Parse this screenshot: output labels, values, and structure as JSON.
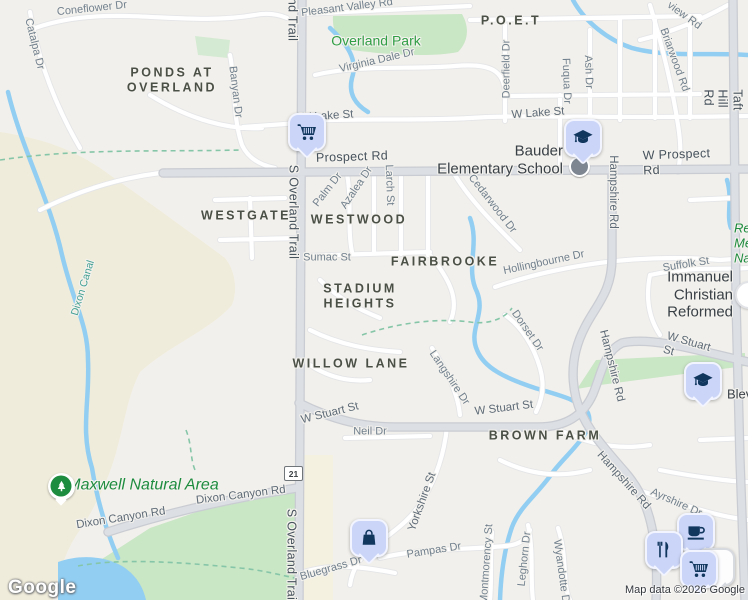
{
  "map": {
    "watermark": "Google",
    "attribution": "Map data ©2026 Google",
    "route_shield": "21",
    "colors": {
      "land": "#f2f0ec",
      "terrain": "#f0ecdb",
      "park": "#c9e6c5",
      "water": "#92cef2",
      "road_major": "#dcdfe4",
      "road_minor": "#ffffff",
      "marker_fill": "#cbd5f8",
      "marker_glyph": "#11375e",
      "poi_green": "#2f9e44",
      "nature_pin_green": "#1e8c3f"
    },
    "neighborhoods": [
      {
        "t": "PONDS AT\nOVERLAND",
        "x": 172,
        "y": 80
      },
      {
        "t": "WESTGATE",
        "x": 246,
        "y": 216
      },
      {
        "t": "WESTWOOD",
        "x": 359,
        "y": 220
      },
      {
        "t": "P.O.E.T",
        "x": 511,
        "y": 21
      },
      {
        "t": "FAIRBROOKE",
        "x": 445,
        "y": 262
      },
      {
        "t": "STADIUM\nHEIGHTS",
        "x": 360,
        "y": 296
      },
      {
        "t": "WILLOW LANE",
        "x": 351,
        "y": 364
      },
      {
        "t": "BROWN FARM",
        "x": 545,
        "y": 436
      }
    ],
    "streets": [
      {
        "t": "Coneflower Dr",
        "x": 92,
        "y": 9,
        "r": -6,
        "c": "s1"
      },
      {
        "t": "Catalpa Dr",
        "x": 34,
        "y": 44,
        "r": 76,
        "c": "s1"
      },
      {
        "t": "Pleasant Valley Rd",
        "x": 347,
        "y": 8,
        "r": -7,
        "c": "s1"
      },
      {
        "t": "S Overland Trail",
        "x": 292,
        "y": -6,
        "r": 90,
        "c": "s3"
      },
      {
        "t": "S Overland Trail",
        "x": 293,
        "y": 212,
        "r": 90,
        "c": "s3"
      },
      {
        "t": "S Overland Trail",
        "x": 291,
        "y": 556,
        "r": 90,
        "c": "s3"
      },
      {
        "t": "S Taft Hill Rd",
        "x": 730,
        "y": 100,
        "r": 90,
        "c": "s3"
      },
      {
        "t": "W Lake St",
        "x": 327,
        "y": 117,
        "r": -4,
        "c": "s2"
      },
      {
        "t": "W Lake St",
        "x": 538,
        "y": 114,
        "r": -4,
        "c": "s2"
      },
      {
        "t": "Virginia Dale Dr",
        "x": 377,
        "y": 61,
        "r": -13,
        "c": "s1"
      },
      {
        "t": "Banyan Dr",
        "x": 235,
        "y": 92,
        "r": 83,
        "c": "s1"
      },
      {
        "t": "Deerfield Dr",
        "x": 507,
        "y": 69,
        "r": -90,
        "c": "s1"
      },
      {
        "t": "Fuqua Dr",
        "x": 566,
        "y": 81,
        "r": 88,
        "c": "s1"
      },
      {
        "t": "Ash Dr",
        "x": 588,
        "y": 72,
        "r": 88,
        "c": "s1"
      },
      {
        "t": "Briarwood Rd",
        "x": 674,
        "y": 60,
        "r": 70,
        "c": "s1"
      },
      {
        "t": "view Rd",
        "x": 684,
        "y": 16,
        "r": 36,
        "c": "s1"
      },
      {
        "t": "Prospect Rd",
        "x": 352,
        "y": 157,
        "r": -2,
        "c": "s3"
      },
      {
        "t": "W Prospect Rd",
        "x": 678,
        "y": 162,
        "r": -2,
        "c": "s3"
      },
      {
        "t": "Palm Dr",
        "x": 328,
        "y": 190,
        "r": -52,
        "c": "s1"
      },
      {
        "t": "Azalea Dr",
        "x": 357,
        "y": 188,
        "r": -56,
        "c": "s1"
      },
      {
        "t": "Larch St",
        "x": 389,
        "y": 185,
        "r": 88,
        "c": "s1"
      },
      {
        "t": "Cedarwood Dr",
        "x": 492,
        "y": 204,
        "r": 52,
        "c": "s1"
      },
      {
        "t": "Hampshire Rd",
        "x": 612,
        "y": 192,
        "r": 90,
        "c": "s2"
      },
      {
        "t": "Hampshire Rd",
        "x": 611,
        "y": 366,
        "r": 76,
        "c": "s2"
      },
      {
        "t": "Hampshire Rd",
        "x": 623,
        "y": 481,
        "r": 48,
        "c": "s2"
      },
      {
        "t": "Sumac St",
        "x": 327,
        "y": 258,
        "r": 0,
        "c": "s1"
      },
      {
        "t": "Hollingbourne Dr",
        "x": 544,
        "y": 263,
        "r": -12,
        "c": "s1"
      },
      {
        "t": "Suffolk St",
        "x": 686,
        "y": 265,
        "r": -9,
        "c": "s1"
      },
      {
        "t": "Dorset Dr",
        "x": 527,
        "y": 331,
        "r": 55,
        "c": "s1"
      },
      {
        "t": "Langshire Dr",
        "x": 449,
        "y": 378,
        "r": 56,
        "c": "s1"
      },
      {
        "t": "W Stuart St",
        "x": 330,
        "y": 414,
        "r": -14,
        "c": "s2"
      },
      {
        "t": "W Stuart St",
        "x": 504,
        "y": 409,
        "r": -7,
        "c": "s2"
      },
      {
        "t": "W Stuart St",
        "x": 692,
        "y": 351,
        "r": 16,
        "c": "s2"
      },
      {
        "t": "Neil Dr",
        "x": 370,
        "y": 432,
        "r": 0,
        "c": "s1"
      },
      {
        "t": "Dixon Canal",
        "x": 83,
        "y": 288,
        "r": -73,
        "c": "t"
      },
      {
        "t": "Dixon Canyon Rd",
        "x": 121,
        "y": 519,
        "r": -9,
        "c": "s2"
      },
      {
        "t": "Dixon Canyon Rd",
        "x": 241,
        "y": 496,
        "r": -7,
        "c": "s2"
      },
      {
        "t": "Bluegrass Dr",
        "x": 331,
        "y": 569,
        "r": -16,
        "c": "s1"
      },
      {
        "t": "Yorkshire St",
        "x": 423,
        "y": 502,
        "r": -70,
        "c": "s2"
      },
      {
        "t": "Pampas Dr",
        "x": 434,
        "y": 551,
        "r": -9,
        "c": "s1"
      },
      {
        "t": "Montmorency St",
        "x": 487,
        "y": 564,
        "r": -86,
        "c": "s1"
      },
      {
        "t": "Leghorn Dr",
        "x": 525,
        "y": 559,
        "r": -84,
        "c": "s1"
      },
      {
        "t": "Wyandotte Dr",
        "x": 561,
        "y": 573,
        "r": 82,
        "c": "s1"
      },
      {
        "t": "Ayrshire Dr",
        "x": 676,
        "y": 503,
        "r": 24,
        "c": "s1"
      }
    ],
    "green_labels": [
      {
        "t": "Overland Park",
        "x": 376,
        "y": 41,
        "c": "g"
      },
      {
        "t": "Maxwell Natural Area",
        "x": 143,
        "y": 486,
        "c": "gi"
      },
      {
        "t": "Re",
        "x": 734,
        "y": 228,
        "c": "gf",
        "a": "l"
      },
      {
        "t": "Me",
        "x": 734,
        "y": 243,
        "c": "gf",
        "a": "l"
      },
      {
        "t": "Natu",
        "x": 734,
        "y": 258,
        "c": "gf",
        "a": "l"
      }
    ],
    "poi_labels": [
      {
        "lines": [
          "Bauder",
          "Elementary School"
        ],
        "x": 563,
        "y": 160,
        "a": "r",
        "c": "p"
      },
      {
        "lines": [
          "Immanuel",
          "Christian Reformed"
        ],
        "x": 733,
        "y": 295,
        "a": "r",
        "c": "p"
      },
      {
        "lines": [
          "Blevins"
        ],
        "x": 727,
        "y": 394,
        "a": "l",
        "c": "pf"
      }
    ],
    "markers": [
      {
        "type": "coffee",
        "icon": "coffee-cup-icon",
        "x": 696,
        "y": 532
      },
      {
        "type": "ghost",
        "icon": "",
        "x": 716,
        "y": 567
      },
      {
        "type": "restaurant",
        "icon": "fork-knife-icon",
        "x": 664,
        "y": 550
      },
      {
        "type": "shopping-cart",
        "icon": "cart-icon",
        "x": 699,
        "y": 569
      },
      {
        "type": "shopping-cart",
        "icon": "cart-icon",
        "x": 307,
        "y": 132
      },
      {
        "type": "school",
        "icon": "graduation-cap-icon",
        "x": 583,
        "y": 138
      },
      {
        "type": "school",
        "icon": "graduation-cap-icon",
        "x": 703,
        "y": 381
      },
      {
        "type": "shopping-bag",
        "icon": "bag-icon",
        "x": 369,
        "y": 538
      },
      {
        "type": "nature",
        "icon": "tree-icon",
        "x": 61,
        "y": 486
      }
    ],
    "poi_circles": [
      {
        "kind": "gray",
        "x": 579,
        "y": 166
      },
      {
        "kind": "white",
        "x": 749,
        "y": 295
      }
    ]
  }
}
